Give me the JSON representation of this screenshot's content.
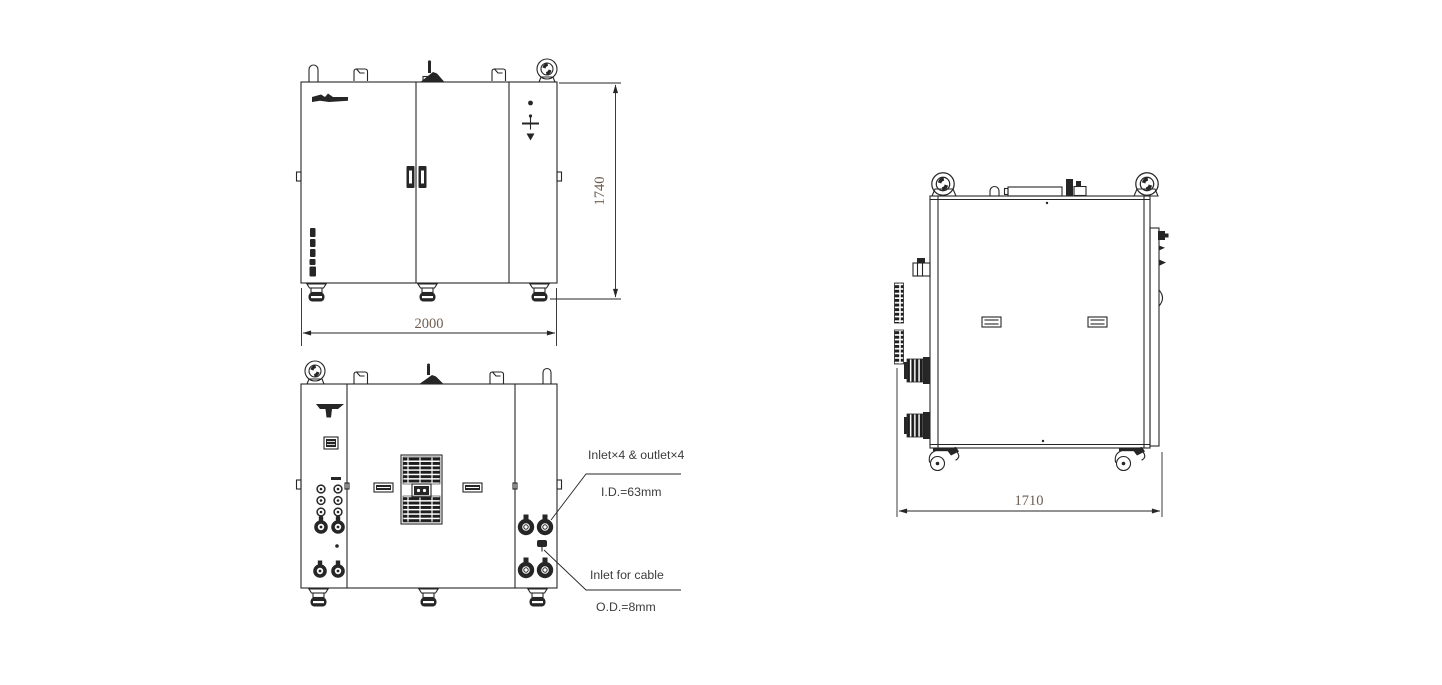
{
  "drawing": {
    "front_view": {
      "height_dimension": "1740",
      "width_dimension": "2000"
    },
    "side_view": {
      "depth_dimension": "1710"
    },
    "rear_view": {
      "callout_ports_title": "Inlet×4 & outlet×4",
      "callout_ports_size": "I.D.=63mm",
      "callout_cable_title": "Inlet for cable",
      "callout_cable_size": "O.D.=8mm"
    }
  },
  "colors": {
    "line": "#262626",
    "dimension_text": "#6e5e52",
    "callout_text": "#3c3c3c",
    "background": "#ffffff"
  }
}
